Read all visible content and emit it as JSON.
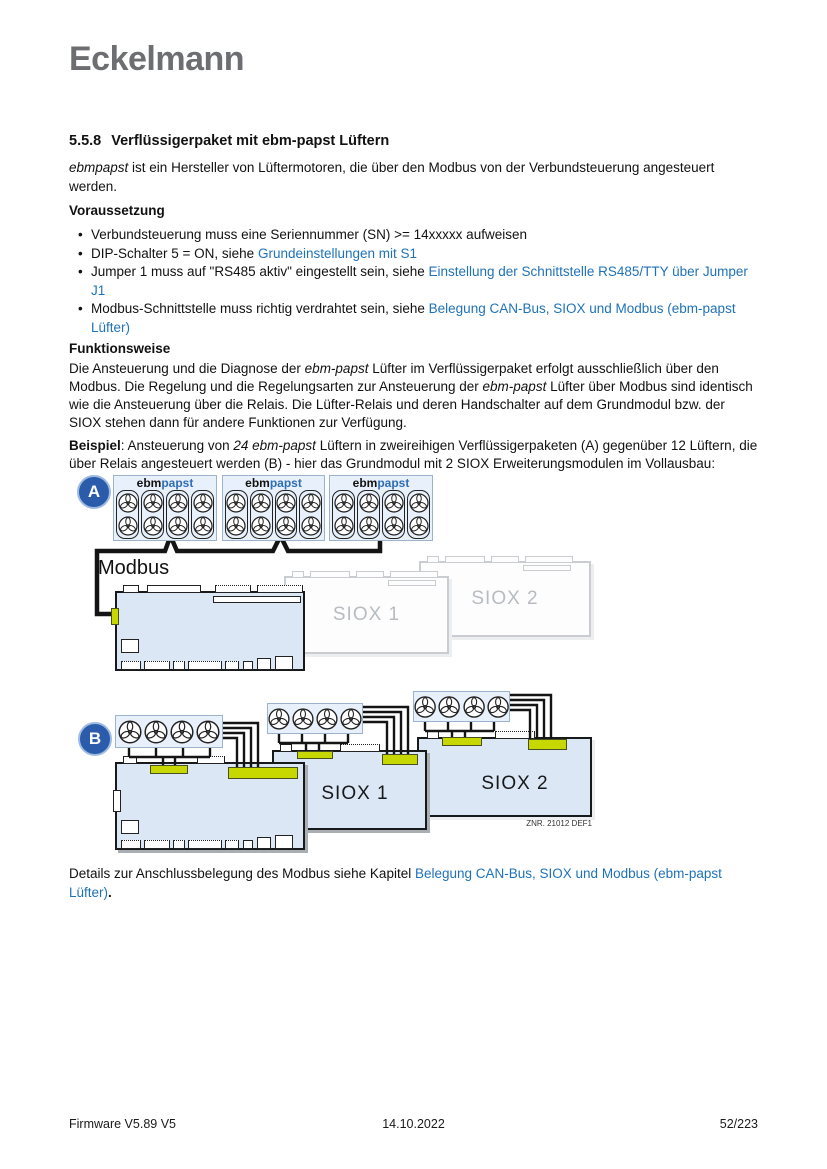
{
  "logo": "Eckelmann",
  "colors": {
    "link_blue": "#1f72b8",
    "badge_blue": "#2b5cac",
    "lime_connector": "#c6d800",
    "module_fill": "#dbe7f4",
    "logo_gray": "#6d6e71",
    "papst_blue": "#2f6db5"
  },
  "heading": {
    "number": "5.5.8",
    "title": "Verflüssigerpaket mit ebm-papst Lüftern"
  },
  "sections": {
    "voraussetzung": "Voraussetzung",
    "funktionsweise": "Funktionsweise"
  },
  "intro": [
    {
      "t": "ebmpapst",
      "s": "italic"
    },
    {
      "t": " ist ein Hersteller von Lüftermotoren, die über den Modbus von der Verbundsteuerung angesteuert werden."
    }
  ],
  "bullets": [
    [
      {
        "t": "Verbundsteuerung muss eine Seriennummer (SN) >= 14xxxxx aufweisen"
      }
    ],
    [
      {
        "t": "DIP-Schalter 5 = ON, siehe "
      },
      {
        "t": "Grundeinstellungen mit S1",
        "s": "link"
      }
    ],
    [
      {
        "t": "Jumper 1 muss auf \"RS485 aktiv\" eingestellt sein, siehe "
      },
      {
        "t": "Einstellung der Schnittstelle RS485/TTY über Jumper J1",
        "s": "link"
      }
    ],
    [
      {
        "t": "Modbus-Schnittstelle muss richtig verdrahtet sein, siehe "
      },
      {
        "t": "Belegung CAN-Bus, SIOX und Modbus (ebm-papst Lüfter)",
        "s": "link"
      }
    ]
  ],
  "funktionsweise_text": [
    {
      "t": "Die Ansteuerung und die Diagnose der "
    },
    {
      "t": "ebm-papst",
      "s": "italic"
    },
    {
      "t": " Lüfter im Verflüssigerpaket erfolgt ausschließlich über den Modbus. Die Regelung und die Regelungsarten zur Ansteuerung der "
    },
    {
      "t": "ebm-papst",
      "s": "italic"
    },
    {
      "t": " Lüfter über Modbus sind identisch wie die Ansteuerung über die Relais. Die Lüfter-Relais und deren Handschalter auf dem Grundmodul bzw. der SIOX stehen dann für andere Funktionen zur Verfügung."
    }
  ],
  "beispiel_text": [
    {
      "t": "Beispiel",
      "s": "bold"
    },
    {
      "t": ": Ansteuerung von "
    },
    {
      "t": "24 ebm-papst",
      "s": "italic"
    },
    {
      "t": " Lüftern in zweireihigen Verflüssigerpaketen (A) gegenüber 12 Lüftern, die über Relais angesteuert werden (B) - hier das Grundmodul mit 2 SIOX Erweiterungsmodulen im Vollausbau:"
    }
  ],
  "closing_text": [
    {
      "t": "Details zur Anschlussbelegung des Modbus siehe Kapitel "
    },
    {
      "t": "Belegung CAN-Bus, SIOX und Modbus (ebm-papst Lüfter)",
      "s": "link"
    },
    {
      "t": ".",
      "s": "bold"
    }
  ],
  "diagram_a": {
    "badge": "A",
    "label_ebm": "ebm",
    "label_papst": "papst",
    "modbus_label": "Modbus",
    "siox1_label": "SIOX 1",
    "siox2_label": "SIOX 2",
    "fan_box_count": 3,
    "fan_rows": 2,
    "fan_cols": 4
  },
  "diagram_b": {
    "badge": "B",
    "group_count": 3,
    "fans_per_group": 4,
    "siox1_label": "SIOX 1",
    "siox2_label": "SIOX 2",
    "znr_label": "ZNR. 21012 DEF1"
  },
  "footer": {
    "left": "Firmware V5.89 V5",
    "center": "14.10.2022",
    "right": "52/223"
  }
}
